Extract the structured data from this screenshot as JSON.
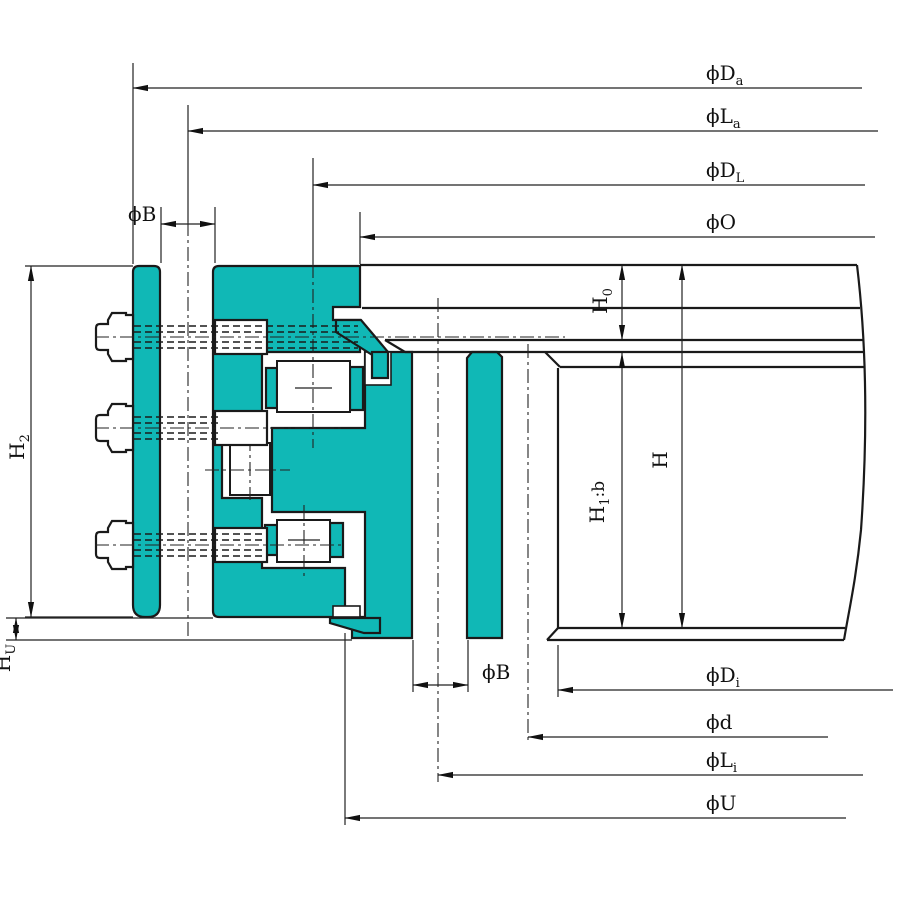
{
  "colors": {
    "section": "#10b8b6",
    "line": "#1a1a1a",
    "dim": "#222222",
    "bg": "#ffffff"
  },
  "labels": {
    "phi_Da": {
      "main": "ϕD",
      "sub": "a"
    },
    "phi_La": {
      "main": "ϕL",
      "sub": "a"
    },
    "phi_DL": {
      "main": "ϕD",
      "sub": "L"
    },
    "phi_O": {
      "main": "ϕO",
      "sub": ""
    },
    "phi_B_top": {
      "main": "ϕB",
      "sub": ""
    },
    "H2": {
      "main": "H",
      "sub": "2"
    },
    "HU": {
      "main": "H",
      "sub": "U"
    },
    "H0": {
      "main": "H",
      "sub": "0"
    },
    "H1b": {
      "main": "H",
      "sub": "1",
      "tail": ":b"
    },
    "H": {
      "main": "H",
      "sub": ""
    },
    "phi_B_bottom": {
      "main": "ϕB",
      "sub": ""
    },
    "phi_Di": {
      "main": "ϕD",
      "sub": "i"
    },
    "phi_d": {
      "main": "ϕd",
      "sub": ""
    },
    "phi_Li": {
      "main": "ϕL",
      "sub": "i"
    },
    "phi_U": {
      "main": "ϕU",
      "sub": ""
    }
  }
}
